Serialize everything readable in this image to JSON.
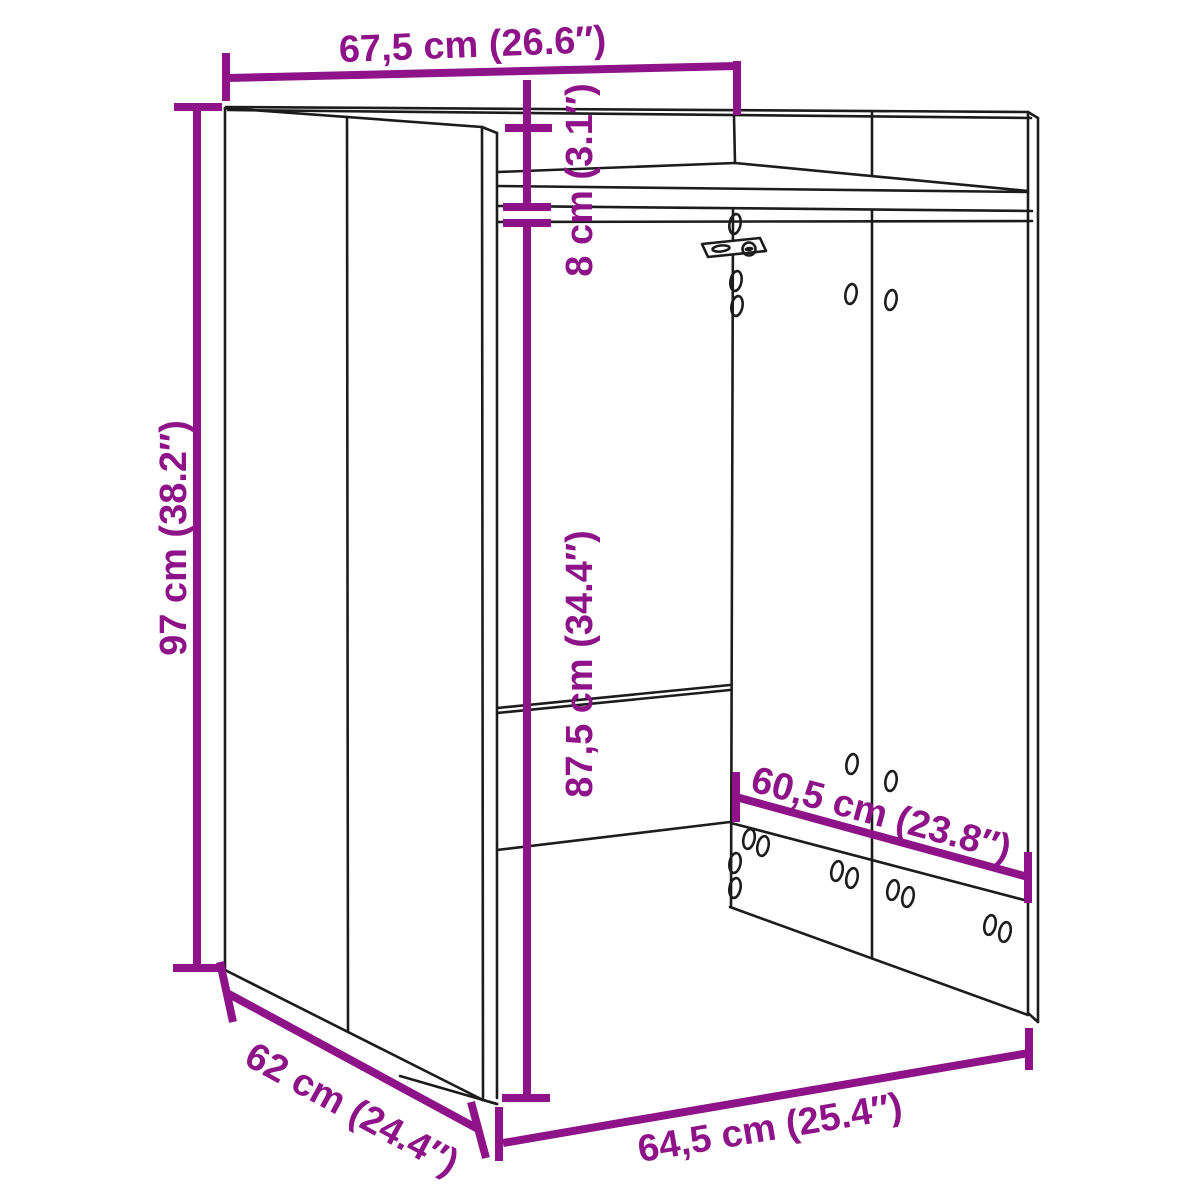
{
  "title": "Washing machine cabinet dimension diagram",
  "colors": {
    "dimension": "#8E1389",
    "outline": "#1c1c1c",
    "background": "#ffffff"
  },
  "dimensions": {
    "outer_width": {
      "label": "67,5 cm (26.6″)"
    },
    "outer_height": {
      "label": "97 cm (38.2″)"
    },
    "top_rail_height": {
      "label": "8 cm (3.1″)"
    },
    "inner_height": {
      "label": "87,5 cm (34.4″)"
    },
    "inner_back_width": {
      "label": "60,5 cm (23.8″)"
    },
    "depth": {
      "label": "62 cm (24.4″)"
    },
    "inner_front_width": {
      "label": "64,5 cm (25.4″)"
    }
  }
}
